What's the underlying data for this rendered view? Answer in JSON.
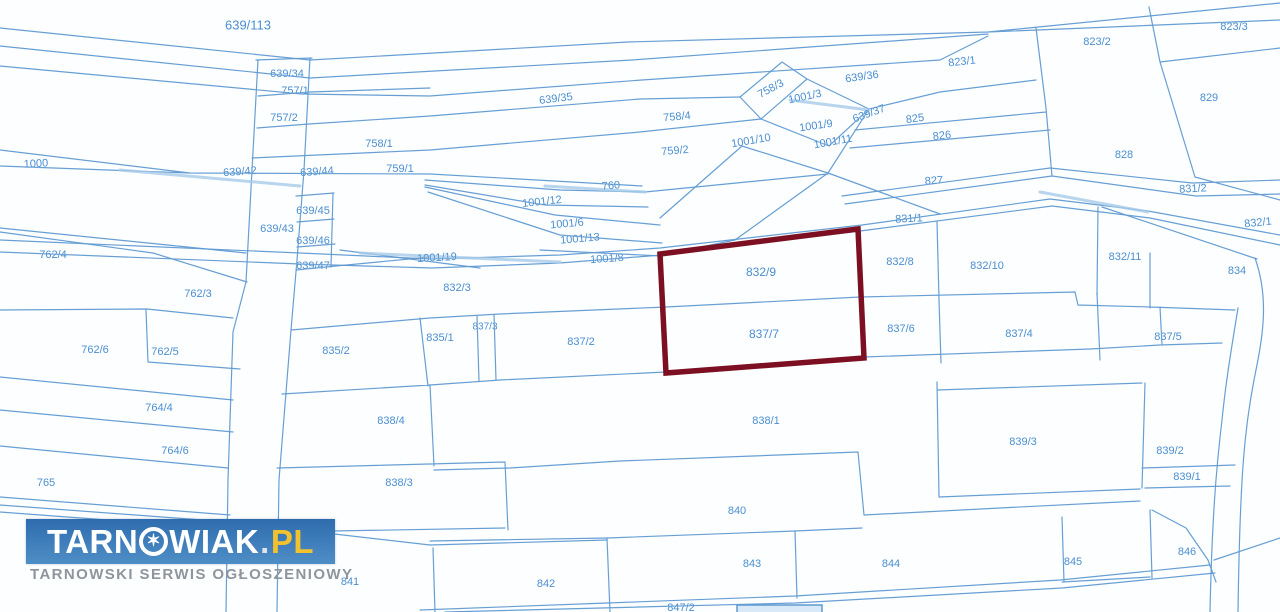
{
  "map": {
    "highlighted_parcels": [
      "832/9",
      "837/7"
    ],
    "parcel_labels": [
      {
        "id": "639/113",
        "x": 248,
        "y": 25,
        "s": 13
      },
      {
        "id": "639/34",
        "x": 287,
        "y": 74
      },
      {
        "id": "757/1",
        "x": 295,
        "y": 91
      },
      {
        "id": "757/2",
        "x": 284,
        "y": 118
      },
      {
        "id": "758/1",
        "x": 379,
        "y": 144
      },
      {
        "id": "759/1",
        "x": 400,
        "y": 169
      },
      {
        "id": "1000",
        "x": 36,
        "y": 164,
        "r": -3
      },
      {
        "id": "639/42",
        "x": 240,
        "y": 172,
        "r": -4
      },
      {
        "id": "639/44",
        "x": 317,
        "y": 172,
        "r": -4
      },
      {
        "id": "639/45",
        "x": 313,
        "y": 211
      },
      {
        "id": "639/43",
        "x": 277,
        "y": 229
      },
      {
        "id": "639/46",
        "x": 313,
        "y": 241
      },
      {
        "id": "639/47",
        "x": 313,
        "y": 266
      },
      {
        "id": "639/35",
        "x": 556,
        "y": 99,
        "r": -7
      },
      {
        "id": "758/4",
        "x": 677,
        "y": 117,
        "r": -5
      },
      {
        "id": "759/2",
        "x": 675,
        "y": 151,
        "r": -5
      },
      {
        "id": "760",
        "x": 611,
        "y": 186,
        "r": -5
      },
      {
        "id": "758/3",
        "x": 771,
        "y": 89,
        "r": -28
      },
      {
        "id": "1001/3",
        "x": 805,
        "y": 97,
        "r": -12
      },
      {
        "id": "1001/9",
        "x": 816,
        "y": 126,
        "r": -8
      },
      {
        "id": "1001/10",
        "x": 751,
        "y": 141,
        "r": -10
      },
      {
        "id": "1001/11",
        "x": 833,
        "y": 142,
        "r": -10
      },
      {
        "id": "639/36",
        "x": 862,
        "y": 77,
        "r": -8
      },
      {
        "id": "639/37",
        "x": 869,
        "y": 114,
        "r": -20
      },
      {
        "id": "825",
        "x": 915,
        "y": 119,
        "r": -8
      },
      {
        "id": "826",
        "x": 942,
        "y": 136,
        "r": -6
      },
      {
        "id": "827",
        "x": 934,
        "y": 181,
        "r": -4
      },
      {
        "id": "823/1",
        "x": 962,
        "y": 62,
        "r": -6
      },
      {
        "id": "823/2",
        "x": 1097,
        "y": 42
      },
      {
        "id": "823/3",
        "x": 1234,
        "y": 27
      },
      {
        "id": "829",
        "x": 1209,
        "y": 98
      },
      {
        "id": "828",
        "x": 1124,
        "y": 155
      },
      {
        "id": "831/2",
        "x": 1193,
        "y": 189,
        "r": -3
      },
      {
        "id": "831/1",
        "x": 909,
        "y": 219,
        "r": -3
      },
      {
        "id": "832/1",
        "x": 1258,
        "y": 223,
        "r": -6
      },
      {
        "id": "1001/12",
        "x": 542,
        "y": 202,
        "r": -6
      },
      {
        "id": "1001/6",
        "x": 567,
        "y": 224,
        "r": -5
      },
      {
        "id": "1001/13",
        "x": 580,
        "y": 239,
        "r": -5
      },
      {
        "id": "1001/8",
        "x": 607,
        "y": 259,
        "r": -4
      },
      {
        "id": "1001/19",
        "x": 437,
        "y": 258,
        "r": -3
      },
      {
        "id": "832/3",
        "x": 457,
        "y": 288
      },
      {
        "id": "832/9",
        "x": 761,
        "y": 272,
        "s": 12
      },
      {
        "id": "832/8",
        "x": 900,
        "y": 262
      },
      {
        "id": "832/10",
        "x": 987,
        "y": 266
      },
      {
        "id": "832/11",
        "x": 1125,
        "y": 257
      },
      {
        "id": "834",
        "x": 1237,
        "y": 271
      },
      {
        "id": "837/7",
        "x": 764,
        "y": 334,
        "s": 12
      },
      {
        "id": "837/6",
        "x": 901,
        "y": 329
      },
      {
        "id": "837/4",
        "x": 1019,
        "y": 334
      },
      {
        "id": "837/5",
        "x": 1168,
        "y": 337
      },
      {
        "id": "762/4",
        "x": 53,
        "y": 255
      },
      {
        "id": "762/3",
        "x": 198,
        "y": 294
      },
      {
        "id": "762/6",
        "x": 95,
        "y": 350
      },
      {
        "id": "762/5",
        "x": 165,
        "y": 352
      },
      {
        "id": "835/2",
        "x": 336,
        "y": 351
      },
      {
        "id": "835/1",
        "x": 440,
        "y": 338
      },
      {
        "id": "837/3",
        "x": 485,
        "y": 327,
        "s": 10
      },
      {
        "id": "837/2",
        "x": 581,
        "y": 342
      },
      {
        "id": "764/4",
        "x": 159,
        "y": 408
      },
      {
        "id": "764/6",
        "x": 175,
        "y": 451
      },
      {
        "id": "765",
        "x": 46,
        "y": 483
      },
      {
        "id": "838/4",
        "x": 391,
        "y": 421
      },
      {
        "id": "838/1",
        "x": 766,
        "y": 421
      },
      {
        "id": "838/3",
        "x": 399,
        "y": 483
      },
      {
        "id": "839/3",
        "x": 1023,
        "y": 442
      },
      {
        "id": "839/2",
        "x": 1170,
        "y": 451
      },
      {
        "id": "839/1",
        "x": 1187,
        "y": 477
      },
      {
        "id": "840",
        "x": 737,
        "y": 511
      },
      {
        "id": "841",
        "x": 350,
        "y": 582
      },
      {
        "id": "842",
        "x": 546,
        "y": 584
      },
      {
        "id": "843",
        "x": 752,
        "y": 564
      },
      {
        "id": "844",
        "x": 891,
        "y": 564
      },
      {
        "id": "845",
        "x": 1073,
        "y": 562
      },
      {
        "id": "846",
        "x": 1187,
        "y": 552
      },
      {
        "id": "847/2",
        "x": 681,
        "y": 608
      }
    ]
  },
  "logo": {
    "brand_prefix": "TARN",
    "brand_suffix": "WIAK",
    "star_icon": "✶",
    "dot": ".",
    "tld": "PL",
    "tagline": "TARNOWSKI SERWIS OGŁOSZENIOWY"
  },
  "colors": {
    "line": "#5f9ad2",
    "line_light": "#a6cbe9",
    "label": "#4b8fd0",
    "highlight": "#7c1022",
    "logo_top": "#2e6cae",
    "logo_bottom": "#4e8ec6",
    "logo_text": "#ffffff",
    "logo_dot": "#dfe5ea",
    "logo_tld": "#f2c12e",
    "tagline": "#8e959c"
  }
}
